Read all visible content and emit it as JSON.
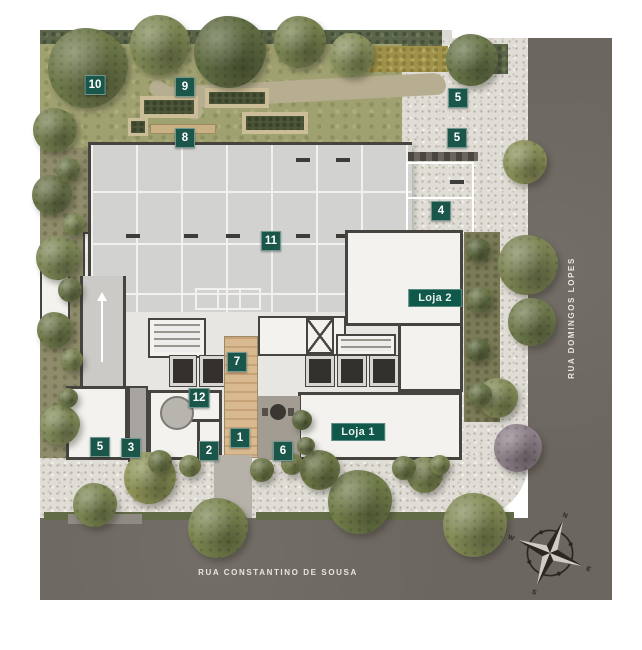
{
  "badges": [
    {
      "label": "10",
      "x": 95,
      "y": 85
    },
    {
      "label": "9",
      "x": 185,
      "y": 87
    },
    {
      "label": "8",
      "x": 185,
      "y": 138
    },
    {
      "label": "5",
      "x": 458,
      "y": 98
    },
    {
      "label": "5",
      "x": 457,
      "y": 138
    },
    {
      "label": "4",
      "x": 441,
      "y": 211
    },
    {
      "label": "11",
      "x": 271,
      "y": 241
    },
    {
      "label": "7",
      "x": 237,
      "y": 362
    },
    {
      "label": "12",
      "x": 199,
      "y": 398
    },
    {
      "label": "5",
      "x": 100,
      "y": 447
    },
    {
      "label": "3",
      "x": 131,
      "y": 448
    },
    {
      "label": "2",
      "x": 209,
      "y": 451
    },
    {
      "label": "1",
      "x": 240,
      "y": 438
    },
    {
      "label": "6",
      "x": 283,
      "y": 451
    }
  ],
  "shops": [
    {
      "label": "Loja 2",
      "x": 435,
      "y": 298
    },
    {
      "label": "Loja 1",
      "x": 358,
      "y": 432
    }
  ],
  "streets": [
    {
      "name": "RUA CONSTANTINO DE SOUSA",
      "orientation": "horizontal"
    },
    {
      "name": "RUA DOMINGOS LOPES",
      "orientation": "vertical"
    }
  ],
  "compass": {
    "n": "N",
    "e": "E",
    "s": "S",
    "w": "W"
  },
  "colors": {
    "badge_green": "#1a574a",
    "shop_green": "#10584a",
    "road_gray": "#6c6660"
  }
}
